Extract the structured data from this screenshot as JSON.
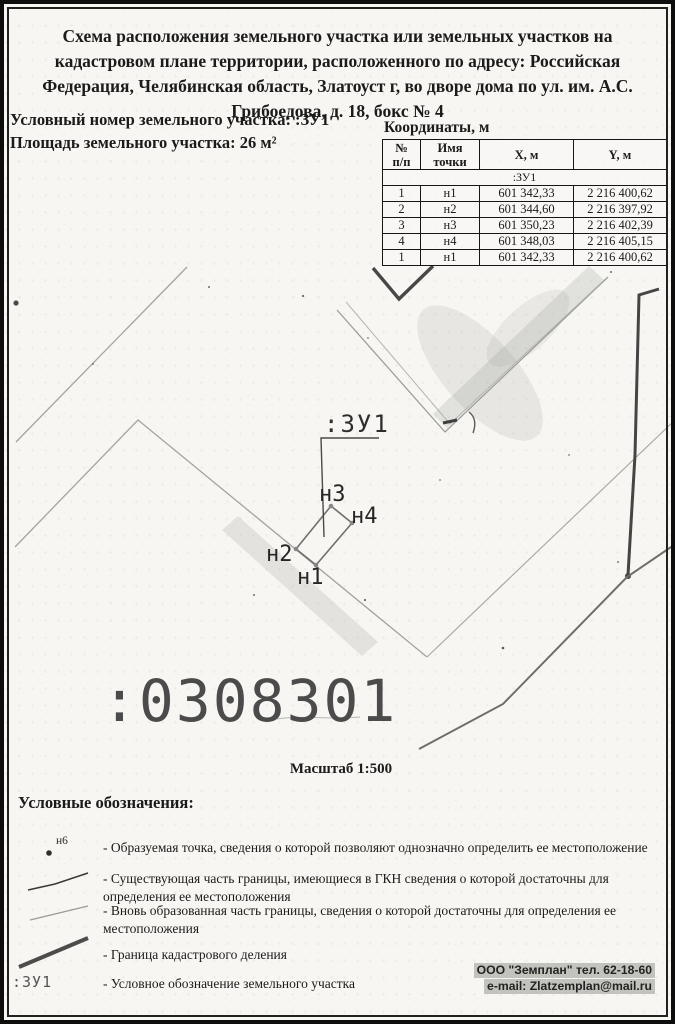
{
  "header": {
    "title": "Схема расположения земельного участка или земельных участков на кадастровом плане территории, расположенного по адресу: Российская Федерация, Челябинская область, Златоуст г, во дворе дома по ул. им. А.С. Грибоедова, д. 18, бокс № 4",
    "conditional_number_line": "Условный номер земельного участка: :ЗУ1",
    "area_line": "Площадь земельного участка: 26 м²"
  },
  "coords_table": {
    "title": "Координаты, м",
    "headers": {
      "num": "№",
      "num_sub": "п/п",
      "name": "Имя",
      "name_sub": "точки",
      "x": "X, м",
      "y": "Y, м"
    },
    "group_row": ":ЗУ1",
    "rows": [
      [
        "1",
        "н1",
        "601 342,33",
        "2 216 400,62"
      ],
      [
        "2",
        "н2",
        "601 344,60",
        "2 216 397,92"
      ],
      [
        "3",
        "н3",
        "601 350,23",
        "2 216 402,39"
      ],
      [
        "4",
        "н4",
        "601 348,03",
        "2 216 405,15"
      ],
      [
        "1",
        "н1",
        "601 342,33",
        "2 216 400,62"
      ]
    ]
  },
  "map": {
    "parcel_label": ":ЗУ1",
    "points": {
      "n1": "н1",
      "n2": "н2",
      "n3": "н3",
      "n4": "н4"
    },
    "quarter_number": ":0308301",
    "scale_label": "Масштаб 1:500"
  },
  "legend": {
    "title": "Условные обозначения:",
    "point_symbol_label": "н6",
    "parcel_symbol_label": ":ЗУ1",
    "items": [
      {
        "text": "- Образуемая точка, сведения о которой позволяют однозначно определить ее местоположение"
      },
      {
        "text": "- Существующая часть границы, имеющиеся в ГКН сведения о которой достаточны для определения ее местоположения"
      },
      {
        "text": "- Вновь образованная часть границы, сведения о которой достаточны для определения ее местоположения"
      },
      {
        "text": "- Граница кадастрового деления"
      },
      {
        "text": "- Условное обозначение земельного участка"
      }
    ]
  },
  "footer": {
    "line1": "ООО \"Земплан\" тел. 62-18-60",
    "line2": "e-mail: Zlatzemplan@mail.ru"
  }
}
